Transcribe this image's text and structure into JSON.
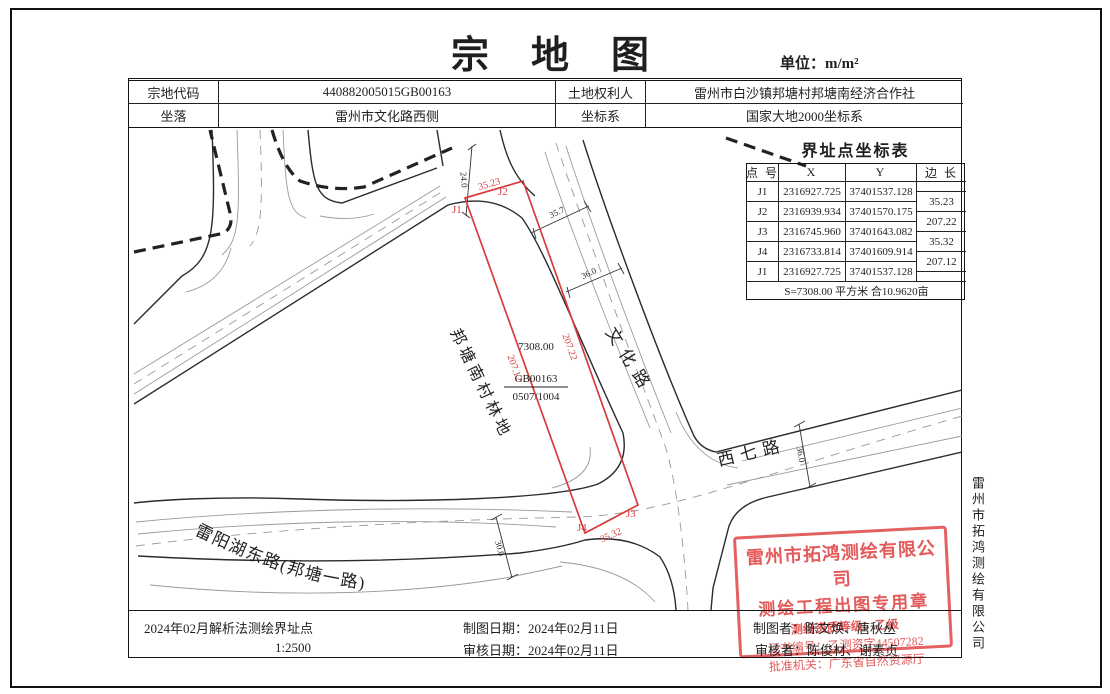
{
  "page": {
    "title": "宗地图",
    "unit": "单位：m/m²"
  },
  "info_table": {
    "r1c1": "宗地代码",
    "r1v1": "440882005015GB00163",
    "r1c2": "土地权利人",
    "r1v2": "雷州市白沙镇邦塘村邦塘南经济合作社",
    "r2c1": "坐落",
    "r2v1": "雷州市文化路西侧",
    "r2c2": "坐标系",
    "r2v2": "国家大地2000坐标系"
  },
  "coord_table": {
    "title": "界址点坐标表",
    "headers": {
      "point": "点 号",
      "x": "X",
      "y": "Y",
      "edge": "边 长"
    },
    "rows": [
      {
        "point": "J1",
        "x": "2316927.725",
        "y": "37401537.128"
      },
      {
        "point": "J2",
        "x": "2316939.934",
        "y": "37401570.175"
      },
      {
        "point": "J3",
        "x": "2316745.960",
        "y": "37401643.082"
      },
      {
        "point": "J4",
        "x": "2316733.814",
        "y": "37401609.914"
      },
      {
        "point": "J1",
        "x": "2316927.725",
        "y": "37401537.128"
      }
    ],
    "edges": [
      "35.23",
      "207.22",
      "35.32",
      "207.12"
    ],
    "area_note": "S=7308.00 平方米 合10.9620亩"
  },
  "map": {
    "land_label": "邦塘南村林地",
    "road_wenhua": "文化路",
    "road_xiqi": "西七路",
    "road_leiyang": "雷阳湖东路(邦塘一路)",
    "parcel_area": "7308.00",
    "parcel_code": "GB00163",
    "parcel_sheet": "0507/1004",
    "pt_j1": "J1",
    "pt_j2": "J2",
    "pt_j3": "J3",
    "pt_j4": "J4",
    "len_top": "35.23",
    "len_right": "207.22",
    "len_bottom": "35.32",
    "len_left": "207.12",
    "dim_road_top": "24.0",
    "dim_357": "35.7",
    "dim_wenhua": "36.0",
    "dim_xiqi": "36.0",
    "dim_leiyang": "30.0"
  },
  "footer": {
    "note": "2024年02月解析法测绘界址点",
    "scale": "1:2500",
    "draw_date": "制图日期：2024年02月11日",
    "review_date": "审核日期：2024年02月11日",
    "drafter": "制图者：陈文焕、唐秋丛",
    "reviewer": "审核者：陈俊材、谢素贞"
  },
  "stamp": {
    "line1": "雷州市拓鸿测绘有限公司",
    "line2": "测绘工程出图专用章",
    "line3": "测绘资质等级：乙级",
    "line4": "证书编号：乙测资字44507282",
    "line5": "批准机关：广东省自然资源厅"
  },
  "side_company": "雷州市拓鸿测绘有限公司",
  "colors": {
    "parcel_red": "#d93a3a",
    "stamp_red": "#e05050",
    "ink": "#1f1f1f"
  }
}
